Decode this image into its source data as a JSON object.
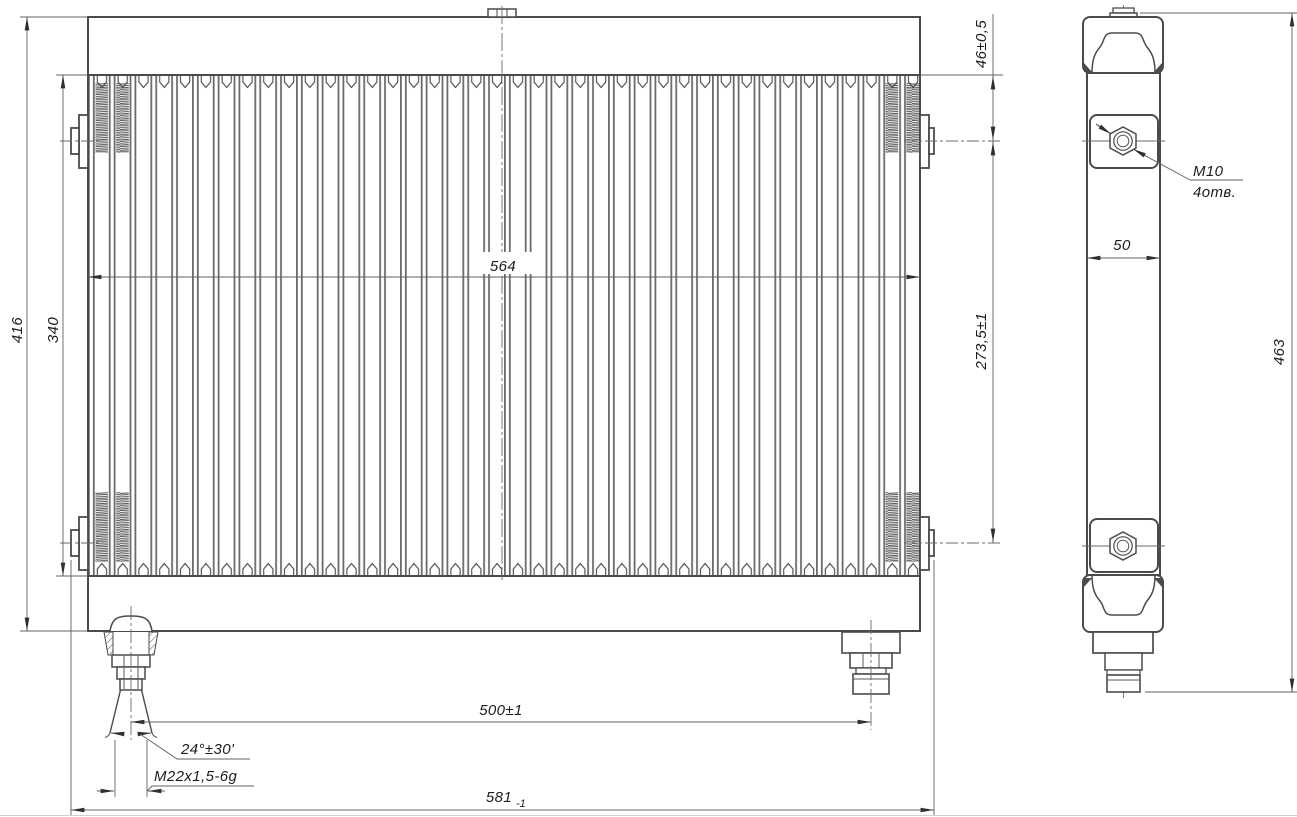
{
  "drawing": {
    "dims": {
      "height_overall": "416",
      "core_height": "340",
      "core_width": "564",
      "top_mount_offset": "46±0,5",
      "mount_span": "273,5±1",
      "port_span": "500±1",
      "cone_angle": "24°±30'",
      "port_thread": "M22x1,5-6g",
      "length_overall": "581",
      "length_overall_tol": "-1",
      "side_width": "50",
      "side_height": "463",
      "mount_thread": "M10",
      "mount_hole_count": "4отв."
    },
    "colors": {
      "outline": "#4b4b4b",
      "thin_line": "#606060",
      "text": "#1c1c1c",
      "background": "#ffffff"
    }
  }
}
